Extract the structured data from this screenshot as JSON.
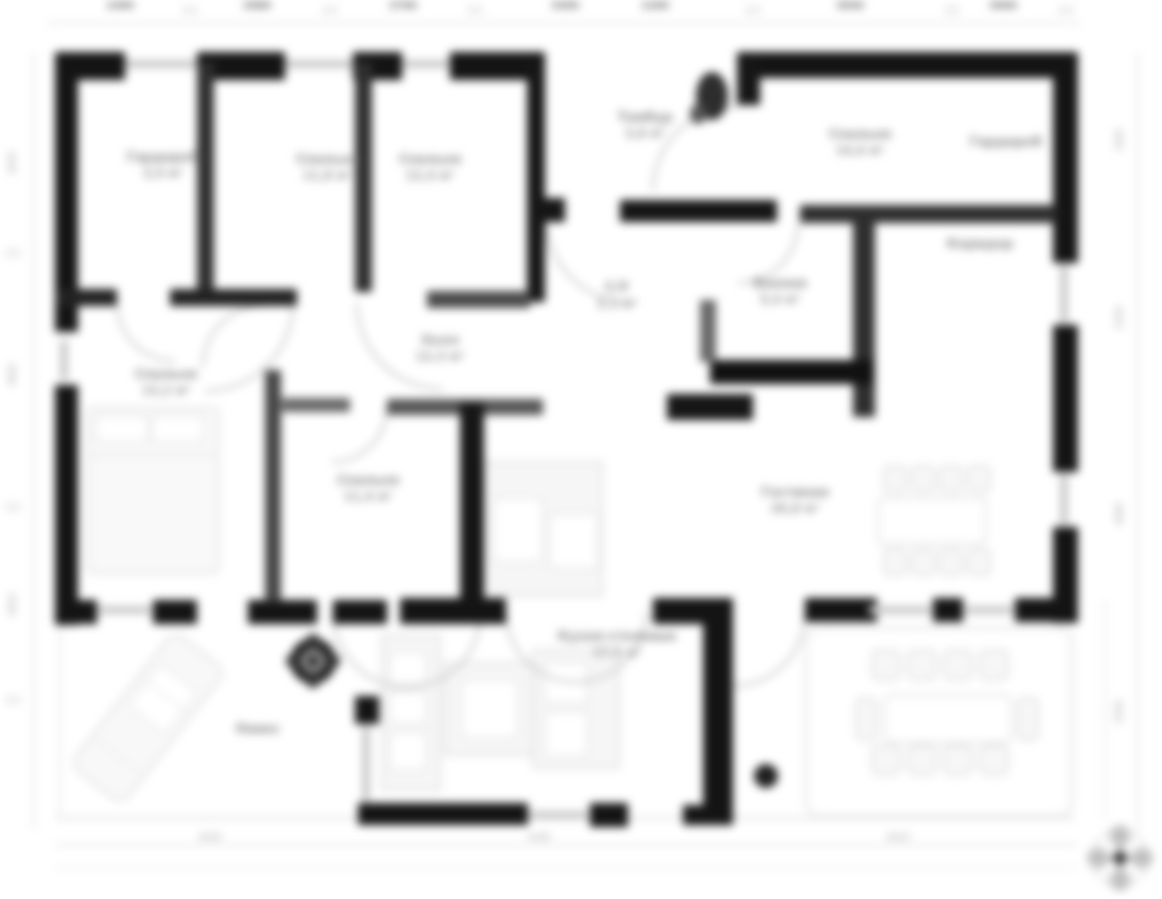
{
  "plan": {
    "rooms": {
      "wardrobe": {
        "name": "Гардероб",
        "area": "3,9 м²"
      },
      "bedroom_top_1": {
        "name": "Спальня",
        "area": "11,8 м²"
      },
      "bedroom_top_2": {
        "name": "Спальня",
        "area": "12,4 м²"
      },
      "vestibule": {
        "name": "Тамбур",
        "area": "3,8 м²"
      },
      "bedroom_right": {
        "name": "Спальня",
        "area": "14,6 м²"
      },
      "closet_right": {
        "name": "Гардероб",
        "area": ""
      },
      "corridor": {
        "name": "Коридор",
        "area": ""
      },
      "wc": {
        "name": "С/У",
        "area": "2,1 м²"
      },
      "bathroom": {
        "name": "Ванная",
        "area": "5,4 м²"
      },
      "hall": {
        "name": "Холл",
        "area": "12,3 м²"
      },
      "bedroom_left": {
        "name": "Спальня",
        "area": "13,2 м²"
      },
      "bedroom_mid": {
        "name": "Спальня",
        "area": "11,4 м²"
      },
      "living": {
        "name": "Гостиная",
        "area": "26,8 м²"
      },
      "kitchen": {
        "name": "Кухня-столовая",
        "area": "17,5 м²"
      },
      "carport": {
        "name": "Навес",
        "area": ""
      }
    },
    "dimensions": {
      "top": [
        "1490",
        "2980",
        "2760",
        "3300",
        "1260",
        "3940",
        "3060"
      ],
      "bottom": [
        "4530",
        "5160",
        "4210"
      ],
      "left": [
        "2870",
        "3920",
        "2610"
      ],
      "right": [
        "1920",
        "2330",
        "2640",
        "2550"
      ]
    }
  }
}
